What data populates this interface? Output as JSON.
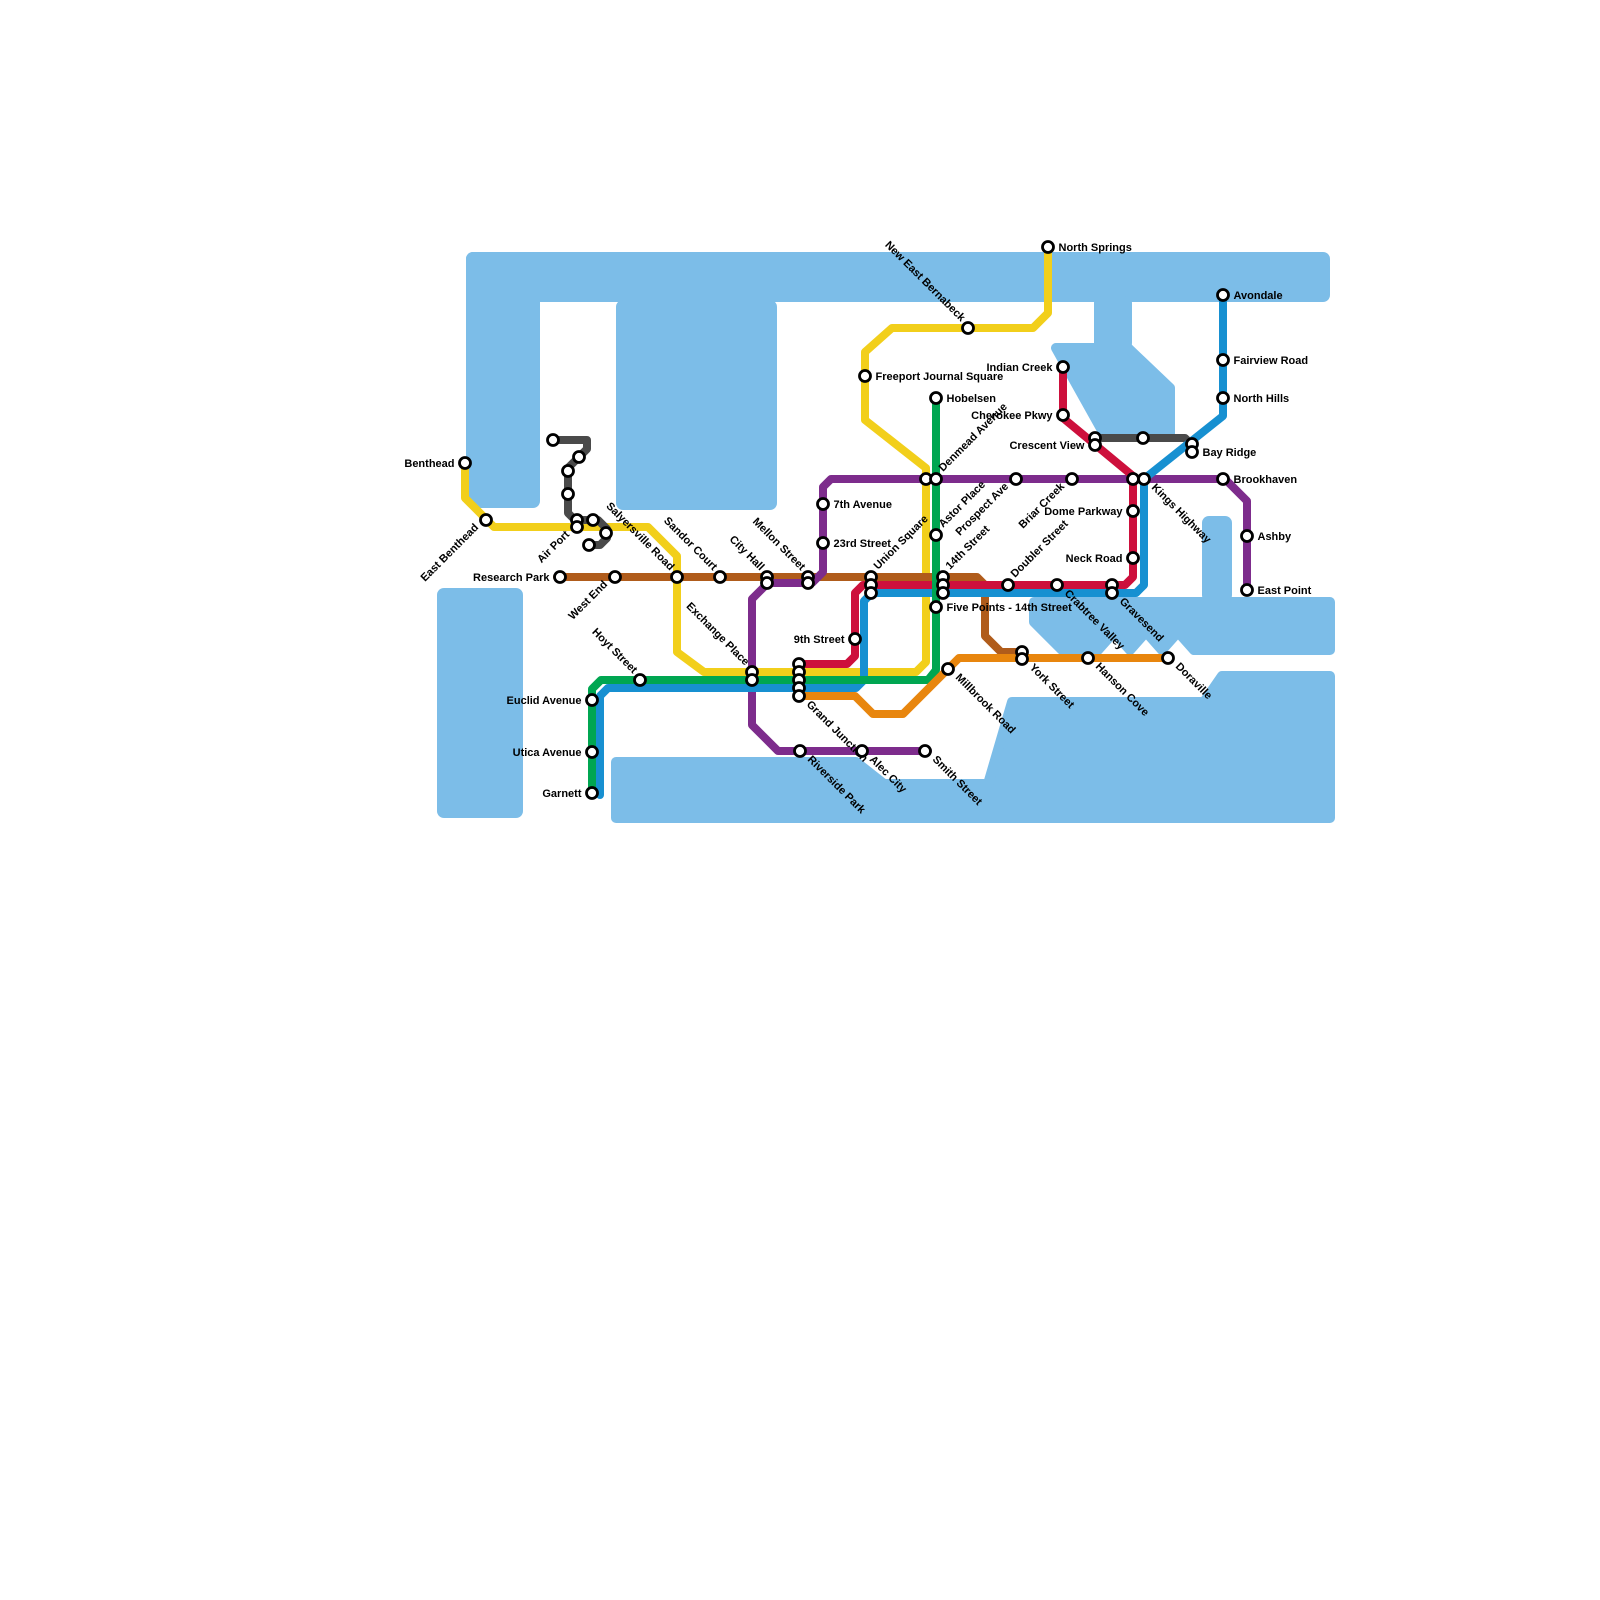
{
  "map": {
    "kind": "transit-map",
    "background": "#ffffff",
    "water_color": "#7cbde8",
    "station_style": {
      "fill": "#ffffff",
      "ring": "#000000",
      "radius": 5.5,
      "ring_width": 2.8
    },
    "label_font_px": 11
  },
  "water": {
    "rects": [
      {
        "x": 466,
        "y": 252,
        "w": 864,
        "h": 50
      },
      {
        "x": 466,
        "y": 252,
        "w": 74,
        "h": 256
      },
      {
        "x": 616,
        "y": 300,
        "w": 161,
        "h": 210
      },
      {
        "x": 1094,
        "y": 296,
        "w": 38,
        "h": 54
      },
      {
        "x": 1202,
        "y": 516,
        "w": 30,
        "h": 86
      },
      {
        "x": 437,
        "y": 588,
        "w": 86,
        "h": 230
      }
    ],
    "polys": [
      [
        [
          1056,
          348
        ],
        [
          1128,
          348
        ],
        [
          1170,
          388
        ],
        [
          1170,
          434
        ],
        [
          1104,
          434
        ]
      ],
      [
        [
          1034,
          602
        ],
        [
          1330,
          602
        ],
        [
          1330,
          650
        ],
        [
          1194,
          650
        ],
        [
          1178,
          632
        ],
        [
          1162,
          650
        ],
        [
          1146,
          632
        ],
        [
          1130,
          650
        ],
        [
          1114,
          632
        ],
        [
          1098,
          650
        ],
        [
          1062,
          650
        ],
        [
          1034,
          622
        ]
      ],
      [
        [
          616,
          818
        ],
        [
          616,
          762
        ],
        [
          856,
          762
        ],
        [
          884,
          784
        ],
        [
          988,
          784
        ],
        [
          1012,
          702
        ],
        [
          1204,
          702
        ],
        [
          1222,
          676
        ],
        [
          1330,
          676
        ],
        [
          1330,
          818
        ]
      ]
    ]
  },
  "lines": [
    {
      "id": "yellow",
      "color": "#f2cf1b",
      "width": 8,
      "points": [
        [
          465,
          461
        ],
        [
          465,
          498
        ],
        [
          494,
          527
        ],
        [
          648,
          527
        ],
        [
          677,
          556
        ],
        [
          677,
          652
        ],
        [
          704,
          672
        ],
        [
          916,
          672
        ],
        [
          926,
          662
        ],
        [
          926,
          468
        ],
        [
          865,
          420
        ],
        [
          865,
          352
        ],
        [
          892,
          328
        ],
        [
          1033,
          328
        ],
        [
          1048,
          313
        ],
        [
          1048,
          247
        ]
      ]
    },
    {
      "id": "gray-shuttle",
      "color": "#4a4a4a",
      "width": 8,
      "points": [
        [
          553,
          440
        ],
        [
          587,
          440
        ],
        [
          587,
          449
        ],
        [
          568,
          468
        ],
        [
          568,
          513
        ],
        [
          575,
          520
        ],
        [
          598,
          520
        ],
        [
          607,
          529
        ],
        [
          607,
          538
        ],
        [
          600,
          545
        ],
        [
          587,
          545
        ]
      ]
    },
    {
      "id": "gray-crosstown",
      "color": "#4a4a4a",
      "width": 8,
      "points": [
        [
          1095,
          438
        ],
        [
          1185,
          438
        ],
        [
          1191,
          444
        ]
      ]
    },
    {
      "id": "brown",
      "color": "#b05c1b",
      "width": 8,
      "points": [
        [
          557,
          577
        ],
        [
          977,
          577
        ],
        [
          985,
          585
        ],
        [
          985,
          636
        ],
        [
          1001,
          652
        ],
        [
          1020,
          652
        ]
      ]
    },
    {
      "id": "purple",
      "color": "#7d2c8c",
      "width": 8,
      "points": [
        [
          928,
          751
        ],
        [
          778,
          751
        ],
        [
          752,
          725
        ],
        [
          752,
          599
        ],
        [
          768,
          583
        ],
        [
          812,
          583
        ],
        [
          823,
          572
        ],
        [
          823,
          487
        ],
        [
          831,
          479
        ],
        [
          1225,
          479
        ],
        [
          1247,
          501
        ],
        [
          1247,
          592
        ]
      ]
    },
    {
      "id": "red",
      "color": "#cd103c",
      "width": 8,
      "points": [
        [
          1063,
          365
        ],
        [
          1063,
          418
        ],
        [
          1133,
          476
        ],
        [
          1133,
          577
        ],
        [
          1125,
          585
        ],
        [
          863,
          585
        ],
        [
          855,
          593
        ],
        [
          855,
          656
        ],
        [
          847,
          664
        ],
        [
          797,
          664
        ]
      ]
    },
    {
      "id": "blue",
      "color": "#1790d1",
      "width": 8,
      "points": [
        [
          1223,
          293
        ],
        [
          1223,
          416
        ],
        [
          1144,
          479
        ],
        [
          1144,
          585
        ],
        [
          1136,
          593
        ],
        [
          872,
          593
        ],
        [
          864,
          601
        ],
        [
          864,
          680
        ],
        [
          856,
          688
        ],
        [
          608,
          688
        ],
        [
          600,
          696
        ],
        [
          600,
          795
        ]
      ]
    },
    {
      "id": "green",
      "color": "#00a651",
      "width": 8,
      "points": [
        [
          936,
          396
        ],
        [
          936,
          670
        ],
        [
          928,
          680
        ],
        [
          601,
          680
        ],
        [
          592,
          689
        ],
        [
          592,
          795
        ]
      ]
    },
    {
      "id": "orange",
      "color": "#e8860e",
      "width": 8,
      "points": [
        [
          797,
          696
        ],
        [
          855,
          696
        ],
        [
          873,
          714
        ],
        [
          903,
          714
        ],
        [
          959,
          658
        ],
        [
          1170,
          658
        ]
      ]
    }
  ],
  "stations": [
    {
      "n": "North Springs",
      "d": [
        [
          1048,
          247
        ]
      ],
      "m": "right"
    },
    {
      "n": "New East Bernabeck",
      "d": [
        [
          968,
          328
        ]
      ],
      "m": "se-end"
    },
    {
      "n": "Freeport Journal Square",
      "d": [
        [
          865,
          376
        ]
      ],
      "m": "right"
    },
    {
      "n": "Hobelsen",
      "d": [
        [
          936,
          398
        ]
      ],
      "m": "right"
    },
    {
      "n": "Avondale",
      "d": [
        [
          1223,
          295
        ]
      ],
      "m": "right"
    },
    {
      "n": "Fairview Road",
      "d": [
        [
          1223,
          360
        ]
      ],
      "m": "right"
    },
    {
      "n": "North Hills",
      "d": [
        [
          1223,
          398
        ]
      ],
      "m": "right"
    },
    {
      "n": "Indian Creek",
      "d": [
        [
          1063,
          367
        ]
      ],
      "m": "left"
    },
    {
      "n": "Cherokee Pkwy",
      "d": [
        [
          1063,
          415
        ]
      ],
      "m": "left"
    },
    {
      "n": "Crescent View",
      "d": [
        [
          1095,
          438
        ],
        [
          1095,
          445
        ]
      ],
      "m": "left",
      "la": 1
    },
    {
      "n": "Bay Ridge",
      "d": [
        [
          1192,
          444
        ],
        [
          1192,
          452
        ]
      ],
      "m": "right",
      "la": 1
    },
    {
      "n": "Brookhaven",
      "d": [
        [
          1223,
          479
        ]
      ],
      "m": "right"
    },
    {
      "n": "Ashby",
      "d": [
        [
          1247,
          536
        ]
      ],
      "m": "right"
    },
    {
      "n": "East Point",
      "d": [
        [
          1247,
          590
        ]
      ],
      "m": "right"
    },
    {
      "n": "Benthead",
      "d": [
        [
          465,
          463
        ]
      ],
      "m": "left"
    },
    {
      "n": "East Benthead",
      "d": [
        [
          486,
          520
        ]
      ],
      "m": "ne-end"
    },
    {
      "n": "Air Port",
      "d": [
        [
          577,
          520
        ],
        [
          577,
          527
        ]
      ],
      "m": "ne-end",
      "la": 1
    },
    {
      "n": "Salyersville Road",
      "d": [
        [
          677,
          577
        ]
      ],
      "m": "se-end"
    },
    {
      "n": "Research Park",
      "d": [
        [
          560,
          577
        ]
      ],
      "m": "left"
    },
    {
      "n": "West End",
      "d": [
        [
          615,
          577
        ]
      ],
      "m": "ne-end"
    },
    {
      "n": "Sandor Court",
      "d": [
        [
          720,
          577
        ]
      ],
      "m": "se-end"
    },
    {
      "n": "City Hall",
      "d": [
        [
          767,
          577
        ],
        [
          767,
          583
        ]
      ],
      "m": "se-end"
    },
    {
      "n": "Mellon Street",
      "d": [
        [
          808,
          577
        ],
        [
          808,
          583
        ]
      ],
      "m": "se-end"
    },
    {
      "n": "7th Avenue",
      "d": [
        [
          823,
          504
        ]
      ],
      "m": "right"
    },
    {
      "n": "23rd Street",
      "d": [
        [
          823,
          543
        ]
      ],
      "m": "right"
    },
    {
      "n": "Denmead Avenue",
      "d": [
        [
          926,
          479
        ],
        [
          936,
          479
        ]
      ],
      "m": "ne-start",
      "la": 1
    },
    {
      "n": "Prospect Ave",
      "d": [
        [
          1016,
          479
        ]
      ],
      "m": "ne-end"
    },
    {
      "n": "Briar Creek",
      "d": [
        [
          1072,
          479
        ]
      ],
      "m": "ne-end"
    },
    {
      "n": "Kings Highway",
      "d": [
        [
          1133,
          479
        ],
        [
          1144,
          479
        ]
      ],
      "m": "se-start",
      "la": 1
    },
    {
      "n": "Dome Parkway",
      "d": [
        [
          1133,
          511
        ]
      ],
      "m": "left"
    },
    {
      "n": "Neck Road",
      "d": [
        [
          1133,
          558
        ]
      ],
      "m": "left"
    },
    {
      "n": "Astor Place",
      "d": [
        [
          936,
          535
        ]
      ],
      "m": "ne-start"
    },
    {
      "n": "Union Square",
      "d": [
        [
          871,
          577
        ],
        [
          871,
          585
        ],
        [
          871,
          593
        ]
      ],
      "m": "ne-start"
    },
    {
      "n": "14th Street",
      "d": [
        [
          943,
          577
        ],
        [
          943,
          585
        ],
        [
          943,
          593
        ]
      ],
      "m": "ne-start"
    },
    {
      "n": "Five Points - 14th Street",
      "d": [
        [
          936,
          607
        ]
      ],
      "m": "right"
    },
    {
      "n": "Doubler Street",
      "d": [
        [
          1008,
          585
        ]
      ],
      "m": "ne-start"
    },
    {
      "n": "Crabtree Valley",
      "d": [
        [
          1057,
          585
        ]
      ],
      "m": "se-start"
    },
    {
      "n": "Gravesend",
      "d": [
        [
          1112,
          585
        ],
        [
          1112,
          593
        ]
      ],
      "m": "se-start",
      "la": 1
    },
    {
      "n": "9th Street",
      "d": [
        [
          855,
          639
        ]
      ],
      "m": "left"
    },
    {
      "n": "Grand Junction",
      "d": [
        [
          799,
          664
        ],
        [
          799,
          672
        ],
        [
          799,
          680
        ],
        [
          799,
          688
        ],
        [
          799,
          696
        ]
      ],
      "m": "se-start",
      "la": 4
    },
    {
      "n": "Exchange Place",
      "d": [
        [
          752,
          672
        ],
        [
          752,
          680
        ]
      ],
      "m": "se-end"
    },
    {
      "n": "Hoyt Street",
      "d": [
        [
          640,
          680
        ]
      ],
      "m": "se-end"
    },
    {
      "n": "Euclid Avenue",
      "d": [
        [
          592,
          700
        ]
      ],
      "m": "left"
    },
    {
      "n": "Utica Avenue",
      "d": [
        [
          592,
          752
        ]
      ],
      "m": "left"
    },
    {
      "n": "Garnett",
      "d": [
        [
          592,
          793
        ]
      ],
      "m": "left"
    },
    {
      "n": "Riverside Park",
      "d": [
        [
          800,
          751
        ]
      ],
      "m": "se-start"
    },
    {
      "n": "Alec City",
      "d": [
        [
          862,
          751
        ]
      ],
      "m": "se-start"
    },
    {
      "n": "Smith Street",
      "d": [
        [
          925,
          751
        ]
      ],
      "m": "se-start"
    },
    {
      "n": "Millbrook Road",
      "d": [
        [
          948,
          669
        ]
      ],
      "m": "se-start"
    },
    {
      "n": "York Street",
      "d": [
        [
          1022,
          652
        ],
        [
          1022,
          659
        ]
      ],
      "m": "se-start",
      "la": 1
    },
    {
      "n": "Hanson Cove",
      "d": [
        [
          1088,
          658
        ]
      ],
      "m": "se-start"
    },
    {
      "n": "Doraville",
      "d": [
        [
          1168,
          658
        ]
      ],
      "m": "se-start"
    },
    {
      "n": "",
      "d": [
        [
          553,
          440
        ]
      ],
      "m": "none"
    },
    {
      "n": "",
      "d": [
        [
          579,
          457
        ]
      ],
      "m": "none"
    },
    {
      "n": "",
      "d": [
        [
          568,
          471
        ]
      ],
      "m": "none"
    },
    {
      "n": "",
      "d": [
        [
          568,
          494
        ]
      ],
      "m": "none"
    },
    {
      "n": "",
      "d": [
        [
          593,
          520
        ]
      ],
      "m": "none"
    },
    {
      "n": "",
      "d": [
        [
          606,
          533
        ]
      ],
      "m": "none"
    },
    {
      "n": "",
      "d": [
        [
          589,
          545
        ]
      ],
      "m": "none"
    },
    {
      "n": "",
      "d": [
        [
          1143,
          438
        ]
      ],
      "m": "none"
    }
  ]
}
